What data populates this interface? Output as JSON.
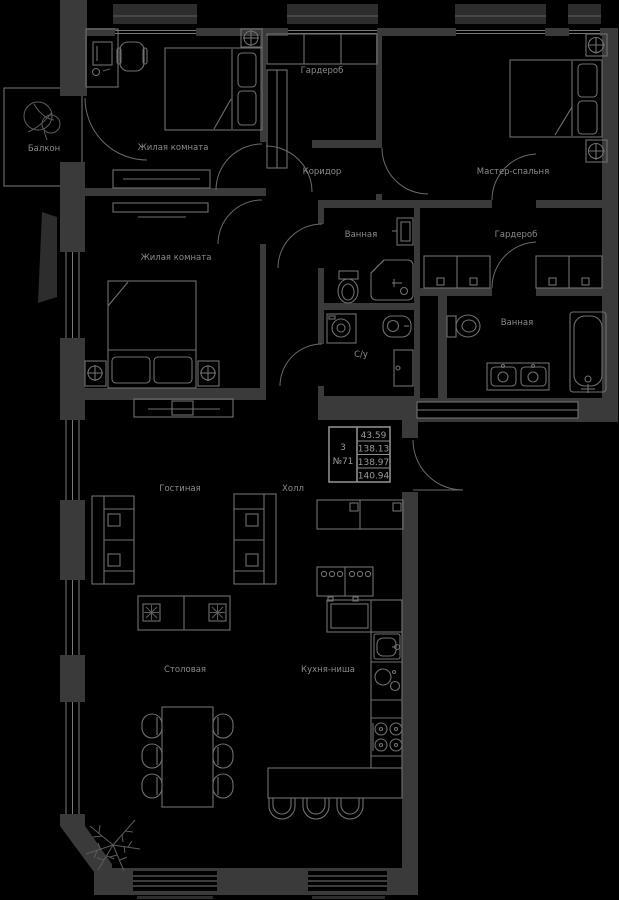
{
  "colors": {
    "background": "#000000",
    "wall": "#3a3a3a",
    "line": "#6f6f6f",
    "text": "#8a8a8a"
  },
  "unit_card": {
    "rooms_count": "3",
    "unit_number": "№71",
    "values": [
      "43.59",
      "138.13",
      "138.97",
      "140.94"
    ]
  },
  "labels": {
    "balcony": "Балкон",
    "living_room_1": "Жилая комната",
    "living_room_2": "Жилая комната",
    "wardrobe_1": "Гардероб",
    "corridor": "Коридор",
    "master_bedroom": "Мастер-спальня",
    "bathroom_1": "Ванная",
    "wardrobe_2": "Гардероб",
    "bathroom_2": "Ванная",
    "wc": "С/у",
    "living_room": "Гостиная",
    "hall": "Холл",
    "dining_room": "Столовая",
    "kitchen": "Кухня-ниша"
  }
}
